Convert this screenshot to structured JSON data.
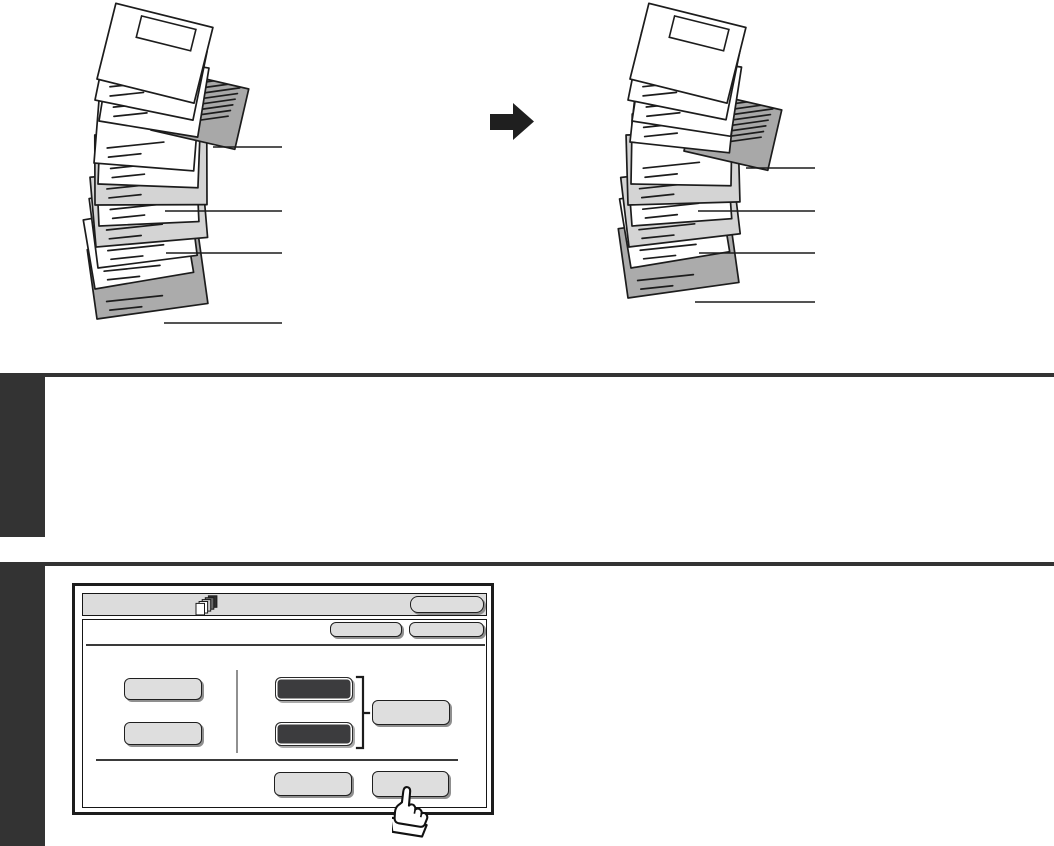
{
  "page": {
    "background": "#ffffff"
  },
  "illustration": {
    "description": "Document stack with cover, printed insert, insert sheets and back cover, shown before and after moving the printed insert one page lower",
    "arrow_icon": "right-arrow",
    "colors": {
      "outline": "#1c1c1c",
      "cover": "#ffffff",
      "white": "#ffffff",
      "printed-insert": "#a8a8a8",
      "light-insert": "#d4d4d4",
      "back-cover": "#ababab",
      "arrow": "#1f1f1f"
    },
    "stacks": [
      {
        "id": "stack-before",
        "sheets": [
          "cover",
          "white",
          "white",
          "printed-insert",
          "white",
          "white",
          "light-insert",
          "white",
          "light-insert",
          "white",
          "white",
          "back-cover"
        ]
      },
      {
        "id": "stack-after",
        "sheets": [
          "cover",
          "white",
          "white",
          "white",
          "printed-insert",
          "white",
          "light-insert",
          "white",
          "light-insert",
          "white",
          "back-cover"
        ]
      }
    ]
  },
  "sections": {
    "tab_color": "#333333",
    "rule_color": "#333333",
    "tabs": [
      {
        "name": "section-tab-1"
      },
      {
        "name": "section-tab-2"
      }
    ]
  },
  "touch_panel": {
    "colors": {
      "frame": "#1c1c1c",
      "bar": "#dcdcdc",
      "button_light": "#dedede",
      "button_dark": "#3c3c3e",
      "shadow": "#8f8f8f"
    },
    "header": {
      "icon": "stacked-pages-icon",
      "title": "",
      "button_label": ""
    },
    "toolbar_buttons": [
      {
        "label": ""
      },
      {
        "label": ""
      }
    ],
    "left_buttons": [
      {
        "label": ""
      },
      {
        "label": ""
      }
    ],
    "dark_buttons": [
      {
        "label": ""
      },
      {
        "label": ""
      }
    ],
    "side_button": {
      "label": ""
    },
    "bottom_buttons": [
      {
        "label": ""
      },
      {
        "label": ""
      }
    ],
    "cursor": "pointing-hand"
  }
}
